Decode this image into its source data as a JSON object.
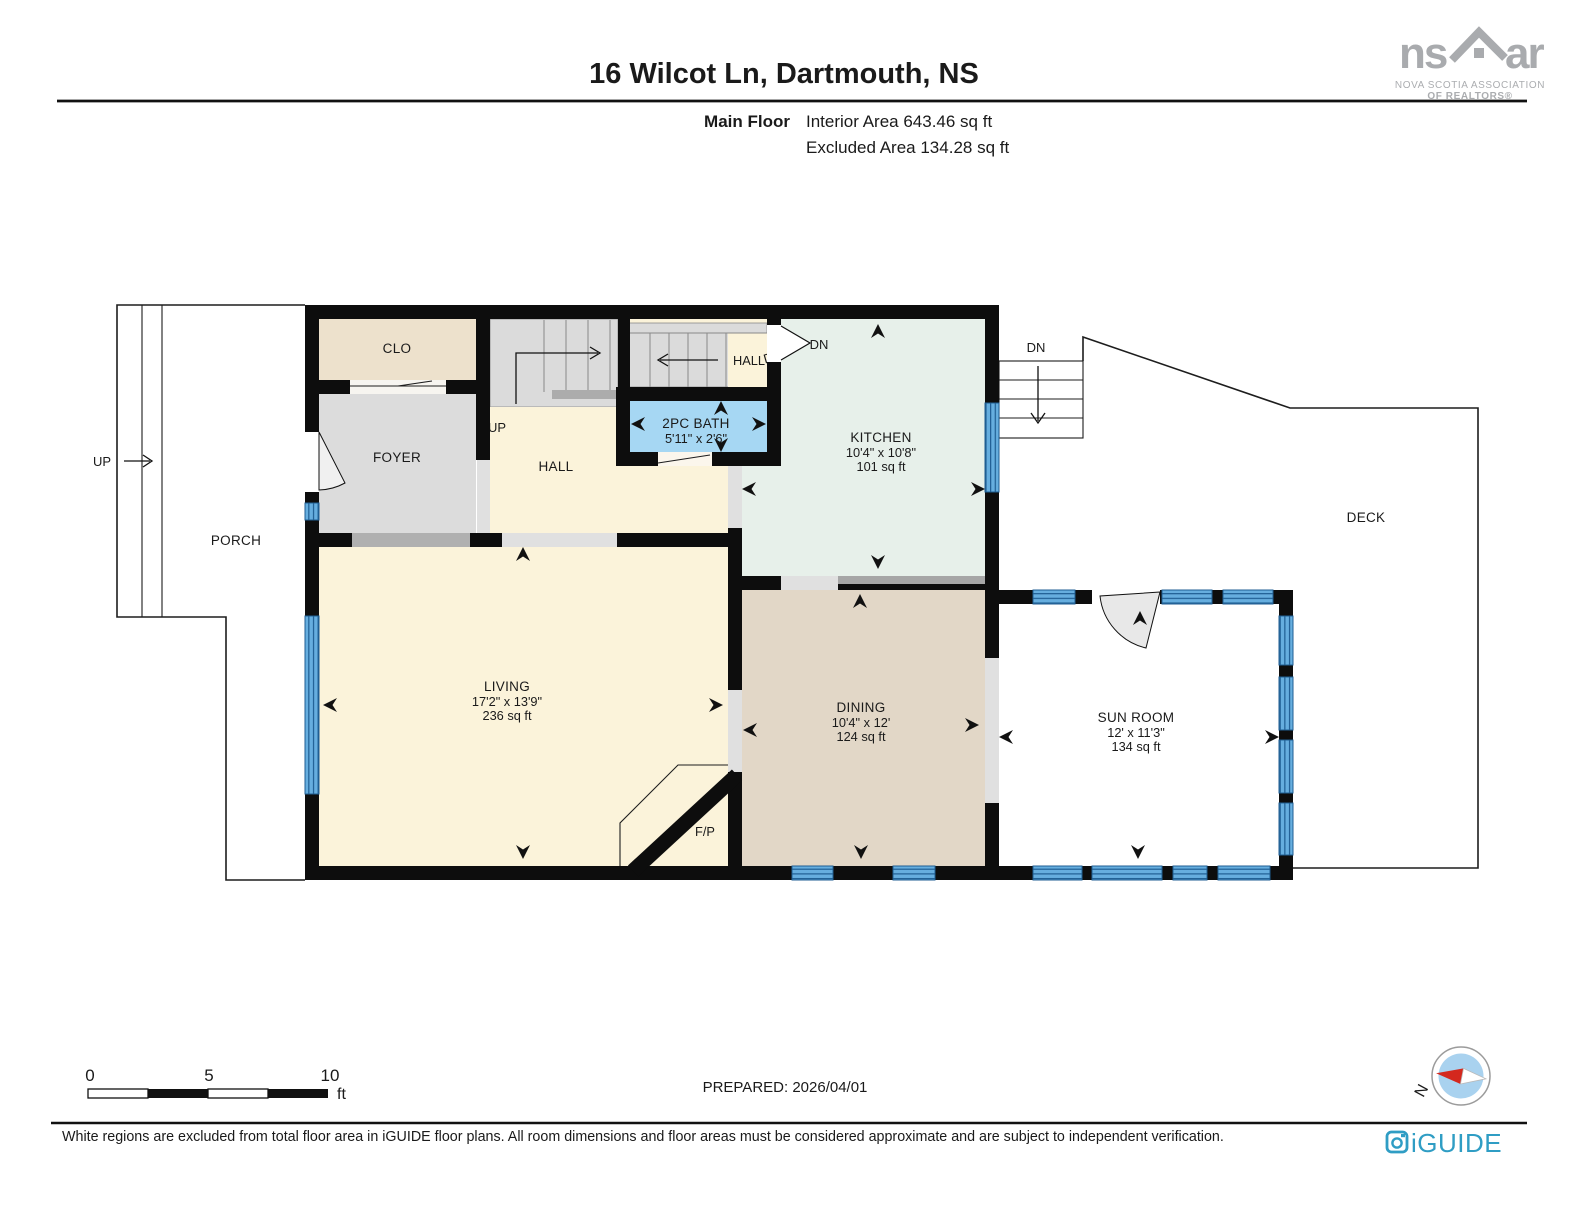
{
  "header": {
    "title": "16 Wilcot Ln, Dartmouth, NS",
    "floor_label": "Main Floor",
    "area_line1": "Interior Area 643.46 sq ft",
    "area_line2": "Excluded Area 134.28 sq ft"
  },
  "nsar": {
    "left": "ns",
    "right": "ar",
    "tagline1": "NOVA SCOTIA ASSOCIATION",
    "tagline2": "OF REALTORS®"
  },
  "plan": {
    "rooms": {
      "clo": {
        "name": "CLO"
      },
      "foyer": {
        "name": "FOYER"
      },
      "hall_upper": {
        "name": "HALL"
      },
      "hall": {
        "name": "HALL"
      },
      "bath": {
        "name": "2PC BATH",
        "dims": "5'11\" x 2'6\""
      },
      "kitchen": {
        "name": "KITCHEN",
        "dims": "10'4\" x 10'8\"",
        "area": "101 sq ft"
      },
      "living": {
        "name": "LIVING",
        "dims": "17'2\" x 13'9\"",
        "area": "236 sq ft"
      },
      "dining": {
        "name": "DINING",
        "dims": "10'4\" x 12'",
        "area": "124 sq ft"
      },
      "sunroom": {
        "name": "SUN ROOM",
        "dims": "12' x 11'3\"",
        "area": "134 sq ft"
      },
      "porch": {
        "name": "PORCH"
      },
      "deck": {
        "name": "DECK"
      },
      "fireplace": {
        "name": "F/P"
      }
    },
    "annotations": {
      "up_porch": "UP",
      "up_stairs": "UP",
      "dn_stairs": "DN",
      "dn_door": "DN",
      "dn_exterior": "DN"
    }
  },
  "scale_bar": {
    "tick0": "0",
    "tick1": "5",
    "tick2": "10",
    "unit": "ft"
  },
  "compass": {
    "north": "N"
  },
  "footer": {
    "prepared": "PREPARED: 2026/04/01",
    "disclaimer": "White regions are excluded from total floor area in iGUIDE floor plans. All room dimensions and floor areas must be considered approximate and are subject to independent verification.",
    "iguide": "iGUIDE"
  },
  "colors": {
    "wall": "#0d0d0d",
    "room_cream": "#FBF3DA",
    "room_gray": "#DCDCDC",
    "room_beige": "#EDE1CC",
    "room_green": "#E7F0EA",
    "room_tan": "#E2D7C7",
    "room_blue": "#A6D7F3",
    "window_blue": "#66AEDF",
    "window_line": "#1f5e93",
    "iguide_teal": "#2f9dc4",
    "nsar_gray": "#a9abae",
    "compass_red": "#d4281e",
    "compass_disc": "#a9d2ef"
  }
}
